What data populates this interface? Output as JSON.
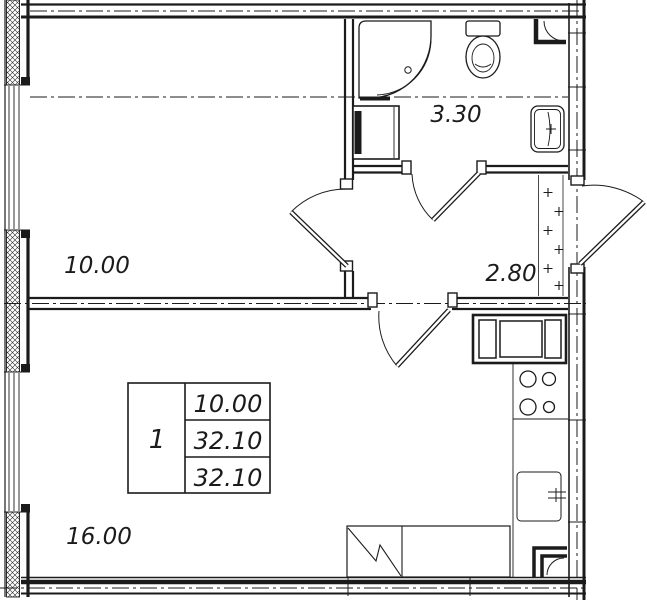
{
  "plan": {
    "rooms": [
      {
        "id": "room-upper",
        "area": "10.00"
      },
      {
        "id": "bathroom",
        "area": "3.30"
      },
      {
        "id": "hallway",
        "area": "2.80"
      },
      {
        "id": "room-lower",
        "area": "16.00"
      }
    ],
    "info_table": {
      "flat_number": "1",
      "rows": [
        "10.00",
        "32.10",
        "32.10"
      ]
    },
    "colors": {
      "line": "#1b1b1b",
      "background": "#ffffff"
    }
  }
}
